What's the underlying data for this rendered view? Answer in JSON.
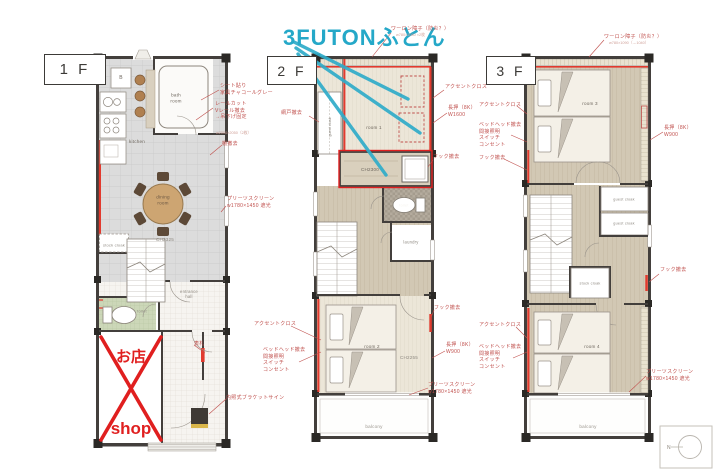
{
  "colors": {
    "wall": "#433f3c",
    "accent_red": "#e23a2e",
    "note_red": "#c0504d",
    "highlight_red": "#e01f1f",
    "marker_blue": "#25a8c8"
  },
  "blue_annotation": {
    "text": "3FUTONふとん"
  },
  "floor_labels": {
    "f1": "1 F",
    "f2": "2 F",
    "f3": "3 F"
  },
  "f1": {
    "b_unit": "B",
    "bath": "bath\nroom",
    "kitchen": "kitchen",
    "dining": "dining\nroom",
    "ceiling": "CH2325",
    "stock_cloak": "stock cloak",
    "toilet": "toilet",
    "entrance": "entrance\nhall",
    "shop_jp": "お店",
    "shop_en": "shop"
  },
  "f2": {
    "guest_cloak": "guest cloak",
    "room1": "room 1",
    "closet_ch": "CH2300",
    "toilet": "toilet",
    "laundry": "laundry",
    "room2": "room 2",
    "ceiling": "CH2255",
    "balcony": "balcony"
  },
  "f3": {
    "room3": "room 3",
    "guest_cloak1": "guest cloak",
    "guest_cloak2": "guest cloak",
    "stock_cloak": "stock cloak",
    "room4": "room 4",
    "balcony": "balcony"
  },
  "notes_1f": {
    "sheet": "シート貼り\n家具チャコールグレー",
    "rail": "レールカット\nVレール撤去\n→吊下げ固定",
    "rail_dim": "w2000×2050（2枚）",
    "shelf": "棚撤去",
    "screen": "プリーツスクリーン\nw1780×1450 遮光",
    "nameplate": "表札",
    "sign": "内照式ブラケットサイン"
  },
  "notes_2f": {
    "shoji": "ワーロン障子（防炎？）",
    "shoji_dim": "w780×1080 ×2枚",
    "amido": "網戸撤去",
    "accent_top": "アクセントクロス",
    "nageshi_top": "長押（8K）\nW1600",
    "hook_top": "フック撤去",
    "accent_bottom": "アクセントクロス",
    "bedhead_bottom": "ベッドヘッド撤去\n間接照明\nスイッチ\nコンセント",
    "hook_bottom": "フック撤去",
    "nageshi_bottom": "長押（8K）\nW900",
    "screen_bottom": "プリーツスクリーン\nw1780×1450 遮光"
  },
  "notes_3f": {
    "shoji": "ワーロン障子（防炎？）",
    "shoji_dim": "w780×1090（→1040）",
    "accent_top": "アクセントクロス",
    "bedhead_top": "ベッドヘッド撤去\n間接照明\nスイッチ\nコンセント",
    "hook_top": "フック撤去",
    "nageshi_top": "長押（8K）\nW900",
    "hook_right": "フック撤去",
    "accent_bottom": "アクセントクロス",
    "bedhead_bottom": "ベッドヘッド撤去\n間接照明\nスイッチ\nコンセント",
    "screen_bottom": "プリーツスクリーン\nw1780×1450 遮光"
  },
  "compass": {
    "label": "N"
  }
}
